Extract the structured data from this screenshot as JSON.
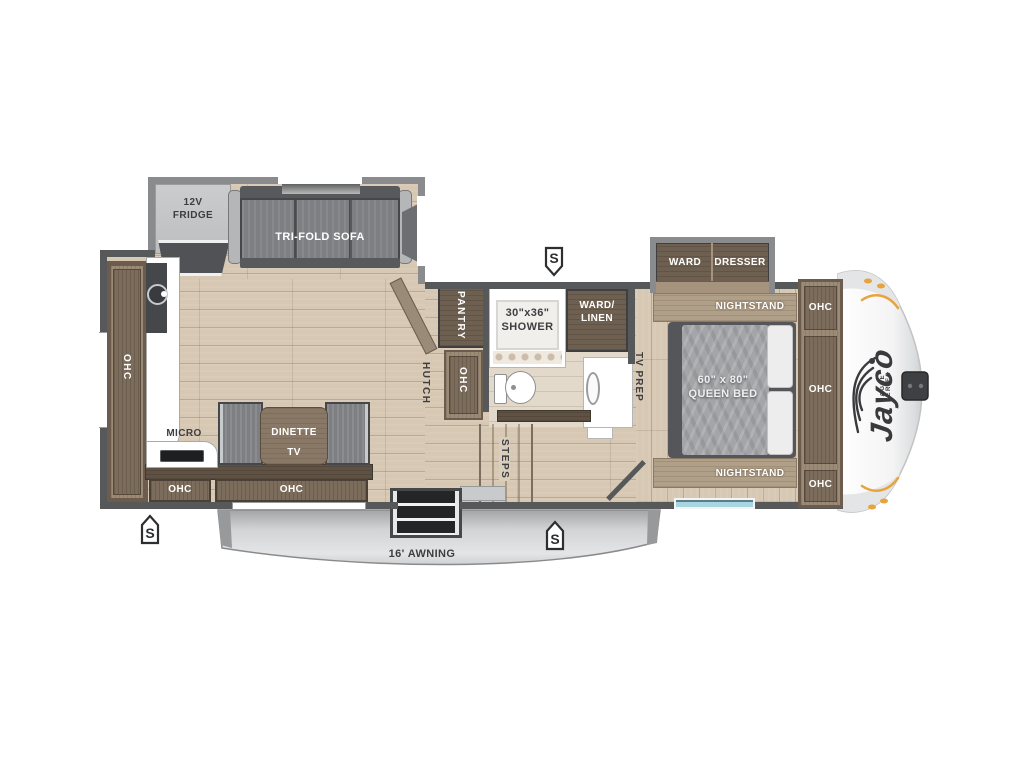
{
  "colors": {
    "wall": "#57585a",
    "slide-wall": "#8a8b8d",
    "floor": "#d7c8b4",
    "bath-floor": "#e3d9cb",
    "cab-dark": "#6e6051",
    "cab-mid": "#7b6c5b",
    "cab-frame": "#9a8a76",
    "cab-band": "#5f5244",
    "sofa": "#7e7f83",
    "mattress": "#a3a5a8",
    "ink": "#3e3e40",
    "orange": "#e8a33d",
    "teal": "#a9d6de"
  },
  "living_area": {
    "fridge_line1": "12V",
    "fridge_line2": "FRIDGE",
    "sofa": "TRI-FOLD SOFA",
    "ohc_left": "OHC",
    "micro": "MICRO",
    "dinette": "DINETTE",
    "tv": "TV",
    "ohc_small": "OHC",
    "ohc_large": "OHC",
    "hutch": "HUTCH",
    "ohc_mid": "OHC",
    "pantry": "PANTRY"
  },
  "bathroom": {
    "shower_line1": "30\"x36\"",
    "shower_line2": "SHOWER",
    "ward_linen_line1": "WARD/",
    "ward_linen_line2": "LINEN",
    "med": "MED",
    "tv_prep": "TV PREP",
    "steps": "STEPS"
  },
  "bedroom": {
    "ward": "WARD",
    "dresser": "DRESSER",
    "nightstand_top": "NIGHTSTAND",
    "nightstand_bottom": "NIGHTSTAND",
    "bed_line1": "60\" x 80\"",
    "bed_line2": "QUEEN BED",
    "ohc_top": "OHC",
    "ohc_mid": "OHC",
    "ohc_bottom": "OHC"
  },
  "exterior": {
    "awning": "16' AWNING",
    "speaker": "S",
    "brand": "Jayco",
    "series": "EAGLE SERIES"
  }
}
